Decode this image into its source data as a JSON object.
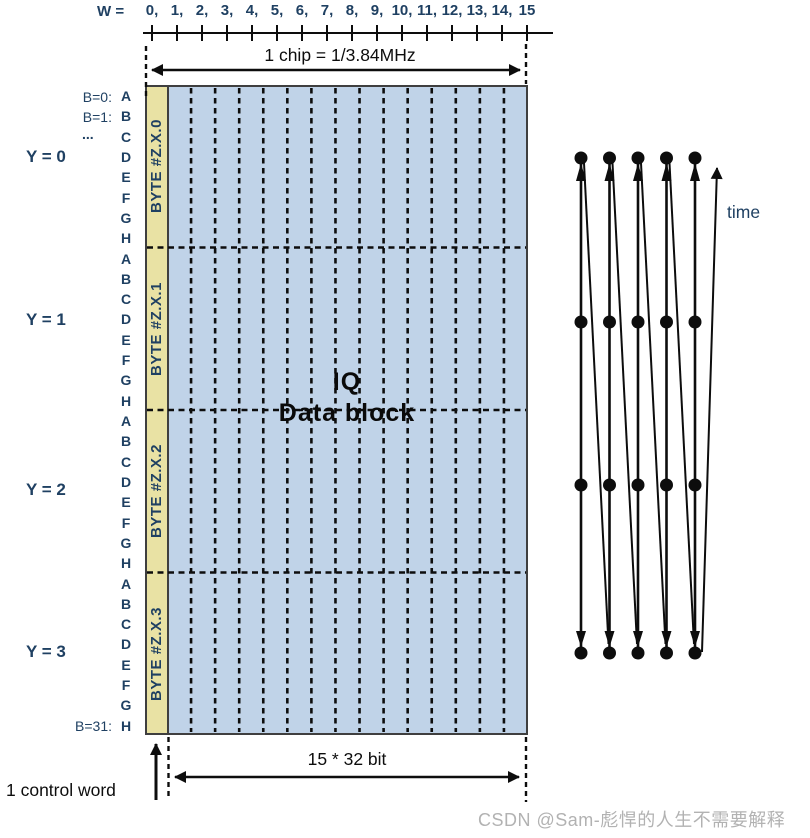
{
  "ruler": {
    "w_label": "W =",
    "tick_labels": [
      "0,",
      "1,",
      "2,",
      "3,",
      "4,",
      "5,",
      "6,",
      "7,",
      "8,",
      "9,",
      "10,",
      "11,",
      "12,",
      "13,",
      "14,",
      "15"
    ]
  },
  "dimensions": {
    "chip_label": "1 chip = 1/3.84MHz",
    "bits_label": "15 * 32 bit",
    "control_label": "1 control word"
  },
  "block": {
    "title_line1": "IQ",
    "title_line2": "Data block",
    "byte_labels": [
      "BYTE #Z.X.0",
      "BYTE #Z.X.1",
      "BYTE #Z.X.2",
      "BYTE #Z.X.3"
    ],
    "data_columns": 15,
    "byte_rows": 4
  },
  "left_labels": {
    "b_first": "B=0:",
    "b_second": "B=1:",
    "ellipsis": "...",
    "b_last": "B=31:",
    "bit_letters": [
      "A",
      "B",
      "C",
      "D",
      "E",
      "F",
      "G",
      "H"
    ],
    "y_labels": [
      "Y = 0",
      "Y = 1",
      "Y = 2",
      "Y = 3"
    ]
  },
  "timeline": {
    "label": "time",
    "lines": 5,
    "dot_levels": 4
  },
  "watermark": "CSDN @Sam-彪悍的人生不需要解释",
  "colors": {
    "label_blue": "#1f4062",
    "control_column_fill": "#e9e2a4",
    "data_block_fill": "#c0d3e8",
    "block_border": "#3f3f3f",
    "line_black": "#0d0d0d",
    "watermark_gray": "#b2b2b2"
  }
}
